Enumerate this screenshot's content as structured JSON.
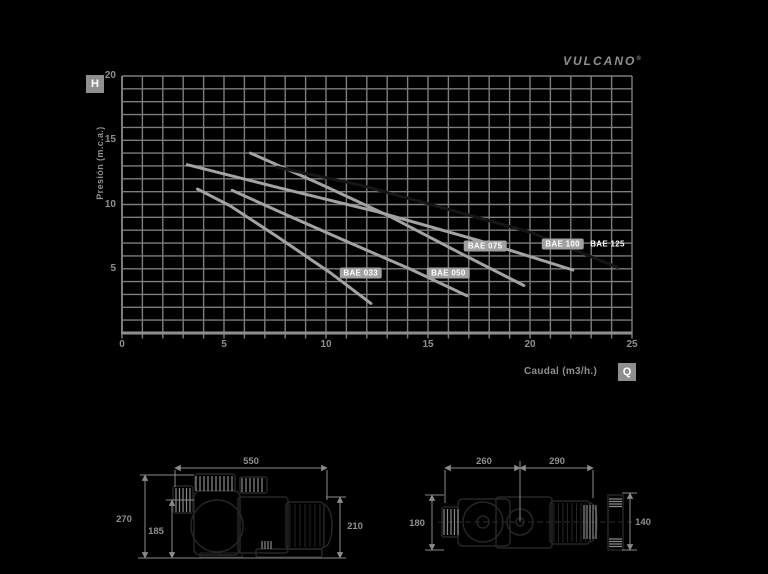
{
  "brand": {
    "name": "VULCANO",
    "registered_mark": "®"
  },
  "axes": {
    "head_badge": "H",
    "flow_badge": "Q"
  },
  "chart_data": {
    "type": "line",
    "title": "",
    "xlabel": "Caudal (m3/h.)",
    "ylabel": "Presión (m.c.a.)",
    "xlim": [
      0,
      25
    ],
    "ylim": [
      0,
      20
    ],
    "x_ticks": [
      0,
      5,
      10,
      15,
      20,
      25
    ],
    "y_ticks": [
      5,
      10,
      15,
      20
    ],
    "grid_step": 1,
    "grid_on": true,
    "grid_color": "#7d7d7d",
    "axis_color": "#8f8f8f",
    "legend_position": "on-curve-labels",
    "series": [
      {
        "name": "BAE 033",
        "color": "#a3a3a3",
        "badge": true,
        "points": [
          [
            3.7,
            11.2
          ],
          [
            5.3,
            9.9
          ],
          [
            7.7,
            7.4
          ],
          [
            10.2,
            4.7
          ],
          [
            12.2,
            2.3
          ]
        ],
        "label_pos": [
          11.7,
          4.7
        ]
      },
      {
        "name": "BAE 050",
        "color": "#a3a3a3",
        "badge": true,
        "points": [
          [
            5.4,
            11.1
          ],
          [
            8.2,
            9.1
          ],
          [
            11.2,
            7.0
          ],
          [
            14.1,
            5.0
          ],
          [
            16.9,
            2.9
          ]
        ],
        "label_pos": [
          16.0,
          4.7
        ]
      },
      {
        "name": "BAE 075",
        "color": "#a3a3a3",
        "badge": true,
        "points": [
          [
            6.3,
            14.0
          ],
          [
            9.7,
            11.6
          ],
          [
            13.1,
            9.1
          ],
          [
            16.6,
            6.2
          ],
          [
            19.7,
            3.7
          ]
        ],
        "label_pos": [
          17.8,
          6.8
        ]
      },
      {
        "name": "BAE 100",
        "color": "#a3a3a3",
        "badge": true,
        "points": [
          [
            3.2,
            13.1
          ],
          [
            7.7,
            11.3
          ],
          [
            12.6,
            9.4
          ],
          [
            17.5,
            7.2
          ],
          [
            22.1,
            4.9
          ]
        ],
        "label_pos": [
          21.6,
          6.9
        ]
      },
      {
        "name": "BAE 125",
        "color": "#161616",
        "badge": false,
        "points": [
          [
            7.6,
            12.9
          ],
          [
            11.7,
            11.5
          ],
          [
            15.6,
            9.8
          ],
          [
            20.1,
            7.8
          ],
          [
            24.3,
            5.1
          ]
        ],
        "label_pos": [
          23.8,
          6.9
        ]
      }
    ]
  },
  "drawings": {
    "side_view": {
      "dims": {
        "length_top": "550",
        "height_overall": "270",
        "height_inlet": "185",
        "height_right": "210"
      }
    },
    "top_view": {
      "dims": {
        "width_front": "260",
        "width_rear": "290",
        "depth": "180",
        "flange": "140"
      }
    }
  }
}
